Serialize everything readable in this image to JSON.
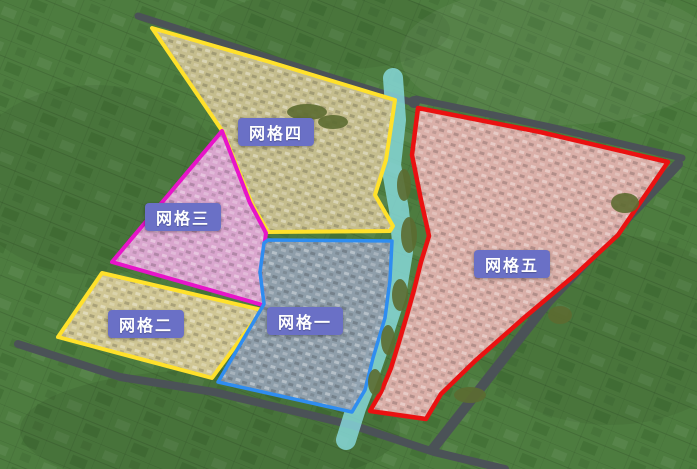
{
  "ui": {
    "label_text_color": "#ffffff",
    "label_bg_color": "#6a70c6"
  },
  "background": {
    "field_color": "#4d7c3f",
    "road_color": "#4b5257",
    "river_color": "#8adde2",
    "tree_color": "#5c6c31"
  },
  "zones": [
    {
      "id": "grid1",
      "label": "网格一",
      "border_color": "#2f8df0",
      "fill_color": "#92a0b0"
    },
    {
      "id": "grid2",
      "label": "网格二",
      "border_color": "#ffe12b",
      "fill_color": "#d7ca99"
    },
    {
      "id": "grid3",
      "label": "网格三",
      "border_color": "#e714c9",
      "fill_color": "#e2a9d6"
    },
    {
      "id": "grid4",
      "label": "网格四",
      "border_color": "#ffe12b",
      "fill_color": "#cbc191"
    },
    {
      "id": "grid5",
      "label": "网格五",
      "border_color": "#ea1111",
      "fill_color": "#e2b2ae"
    }
  ]
}
